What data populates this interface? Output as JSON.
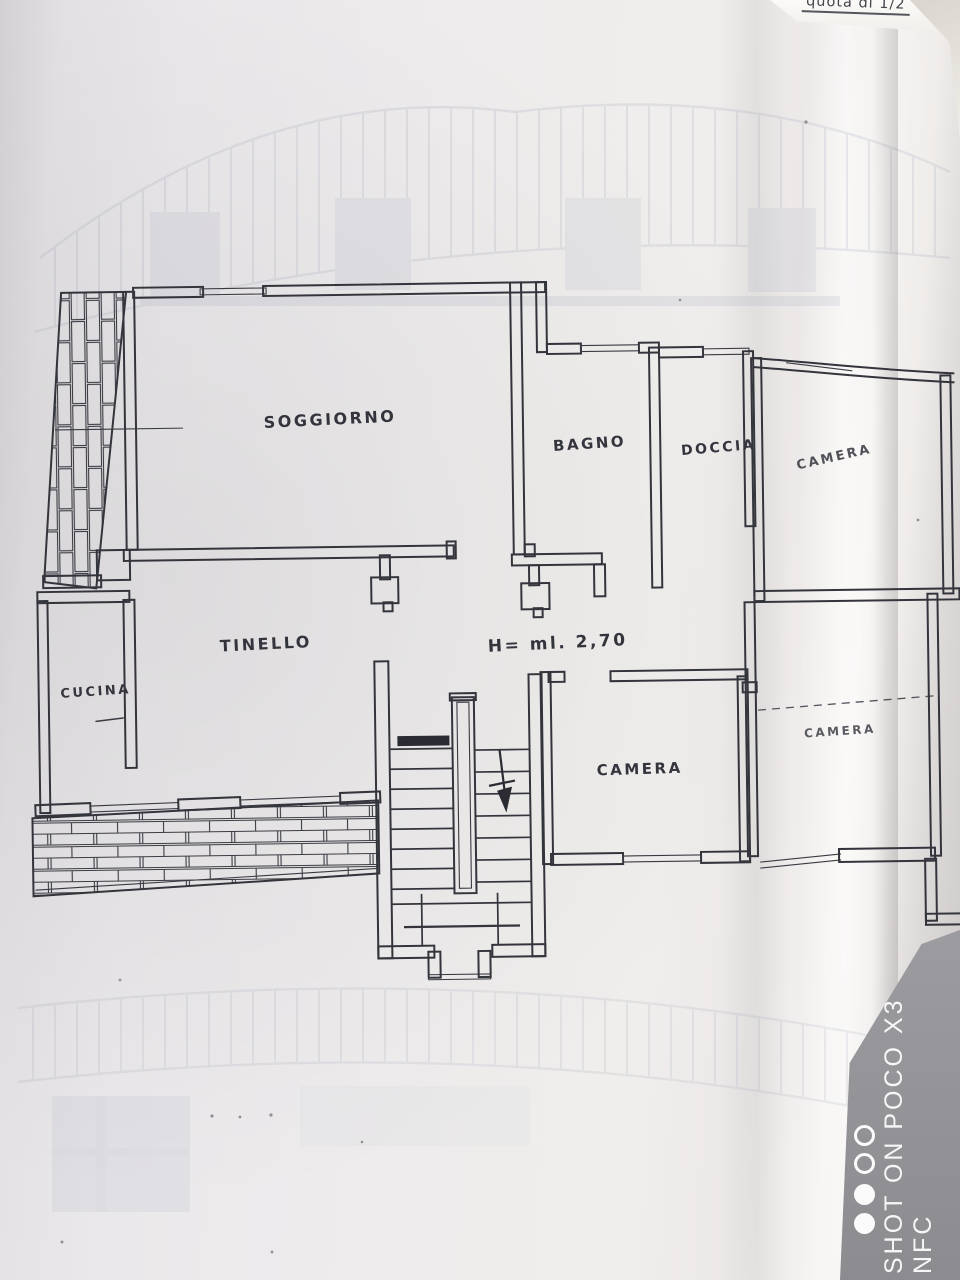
{
  "page": {
    "corner_note": "quota di 1/2",
    "watermark_text": "SHOT ON POCO X3 NFC"
  },
  "floor_plan": {
    "height_note": "H= ml. 2,70",
    "rooms": {
      "soggiorno": "SOGGIORNO",
      "bagno": "BAGNO",
      "doccia": "DOCCIA",
      "camera_top_right": "CAMERA",
      "tinello": "TINELLO",
      "cucina": "CUCINA",
      "camera_center": "CAMERA",
      "camera_right": "CAMERA"
    }
  }
}
